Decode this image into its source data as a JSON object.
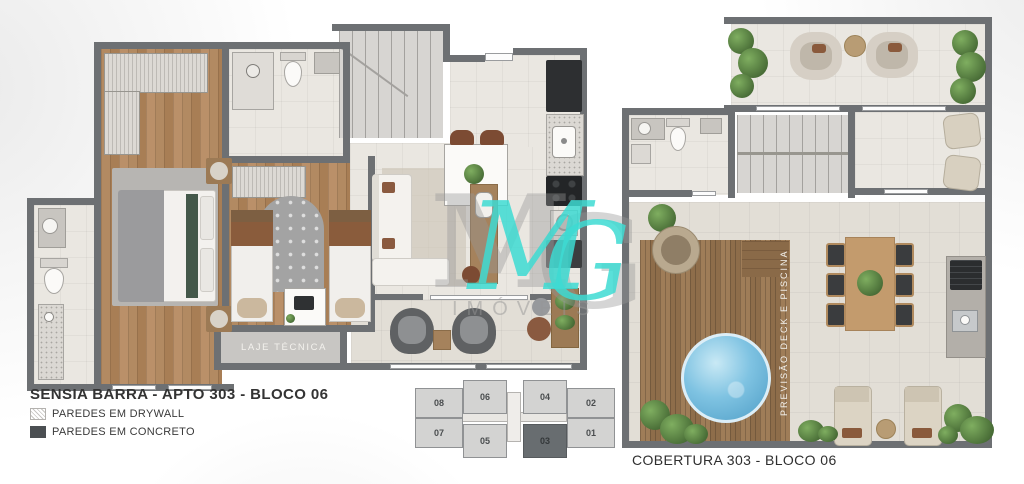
{
  "titles": {
    "left": "SENSIA BARRA -  APTO 303 - BLOCO 06",
    "right": "COBERTURA 303  - BLOCO 06"
  },
  "legend": {
    "drywall": "PAREDES EM DRYWALL",
    "concrete": "PAREDES EM CONCRETO"
  },
  "plan_labels": {
    "laje_tecnica": "LAJE TÉCNICA",
    "deck": "PREVISÃO DECK E PISCINA"
  },
  "key_plan": {
    "top_row": [
      "08",
      "06",
      "04",
      "02"
    ],
    "bottom_row": [
      "07",
      "05",
      "03",
      "01"
    ],
    "highlighted_unit": "03"
  },
  "watermark": {
    "letter_m": "M",
    "letter_g": "G",
    "word": "IMÓVEIS",
    "teal_color": "#3ddbd2"
  },
  "colors": {
    "wall": "#6d7073",
    "wood_floor": "#ab8058",
    "tile_floor": "#eae7e1",
    "deck_wood": "#97775a",
    "pool_blue": "#6fb6da",
    "legend_concrete": "#4b4f52",
    "watermark_teal": "#3ddbd2"
  }
}
